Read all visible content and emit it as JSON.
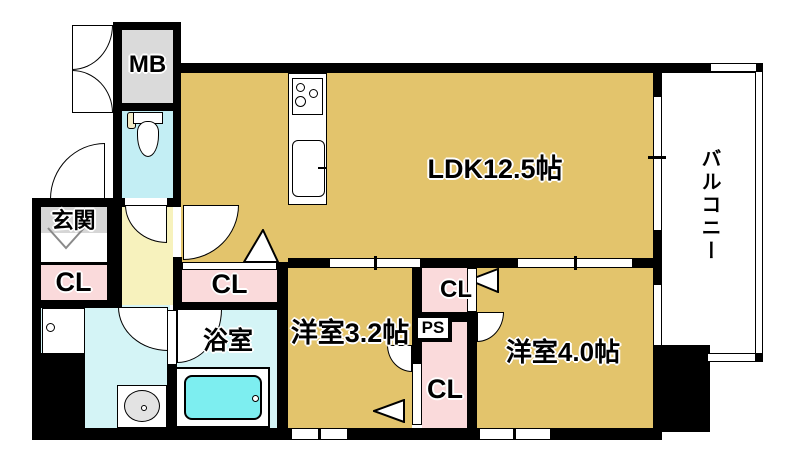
{
  "plan": {
    "title": "1LDK apartment floor plan",
    "labels": {
      "mb": "MB",
      "genkan": "玄関",
      "cl_entry": "CL",
      "cl_hall": "CL",
      "bathroom": "浴室",
      "ldk": "LDK12.5帖",
      "balcony": "バルコニー",
      "room_32": "洋室3.2帖",
      "room_40": "洋室4.0帖",
      "cl_upper": "CL",
      "ps": "PS",
      "cl_lower": "CL"
    },
    "colors": {
      "wall": "#000000",
      "room_tan": "#e3c46c",
      "closet_pink": "#fadadb",
      "hall_yellow": "#f7f2bd",
      "wet_cyan": "#d4f4f6",
      "toilet_cyan": "#c3eef4",
      "tub_cyan": "#7deef0",
      "mb_gray": "#dadada",
      "label_gray": "#d6d6d6",
      "fixture_gray": "#e3e3e3",
      "bg": "#ffffff"
    }
  }
}
